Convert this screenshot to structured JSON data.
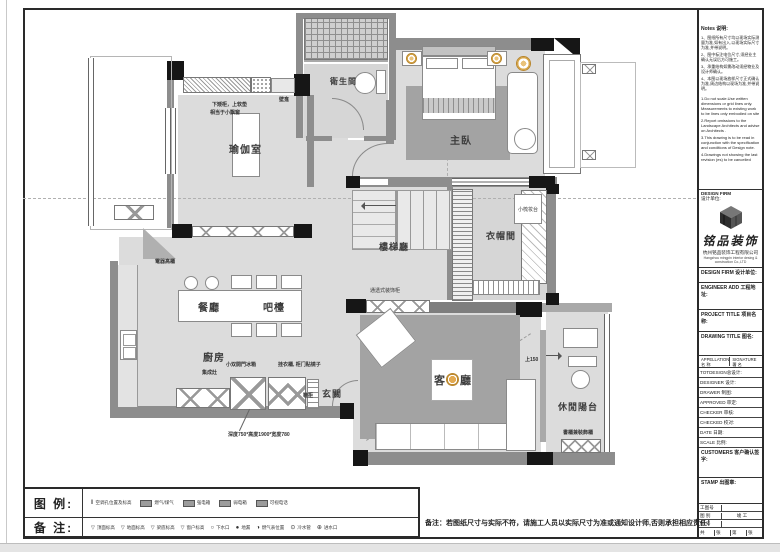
{
  "page": {
    "legend_caption": "图 例:",
    "remark_caption": "备 注:",
    "bottom_remark": "备注：若图纸尺寸与实际不符，请施工人员以实际尺寸为准或通知设计师,否则承担相应责任！"
  },
  "plan": {
    "rooms": {
      "yoga": "瑜伽室",
      "bath": "衛生間",
      "master": "主臥",
      "cloak": "衣帽間",
      "stair": "樓梯廳",
      "dining": "餐廳",
      "bar": "吧檯",
      "kitchen": "廚房",
      "foyer": "玄關",
      "living_left": "客",
      "living_right": "廳",
      "balcony": "休閒陽台"
    },
    "annotations": {
      "seat1": "下矮柜，上软垫",
      "seat2": "相当于小飘窗",
      "niche": "壁龛",
      "elec_cabinet": "電器高櫃",
      "dresser": "小梳妆台",
      "display_cabinet": "通透式装饰柜",
      "stove": "集成灶",
      "fridge": "小双開門冰箱",
      "wardrobe": "挂衣櫃, 柜门贴镜子",
      "shoe": "鞋柜",
      "size_note": "深度750*高度1900*宽度780",
      "up150": "上150",
      "bookcase": "書櫃兼裝飾櫃"
    }
  },
  "legend": {
    "row1": [
      {
        "label": "空调孔位置及标高"
      },
      {
        "label": "燃气/煤气"
      },
      {
        "label": "强电箱"
      },
      {
        "label": "弱电箱"
      },
      {
        "label": "可视电话"
      }
    ],
    "row2": [
      {
        "label": "顶面标高"
      },
      {
        "label": "地面标高"
      },
      {
        "label": "梁底标高"
      },
      {
        "label": "窗户标高"
      },
      {
        "label": "下水口"
      },
      {
        "label": "地漏"
      },
      {
        "label": "燃气表位置"
      },
      {
        "label": "冷水管"
      },
      {
        "label": "进水口"
      }
    ],
    "icons": {
      "drain_open": "○",
      "drain_dot": "●",
      "gas_meter": "◑",
      "cold_pipe": "⊙",
      "inlet": "⊕",
      "elev": "▽",
      "dbl": "‖"
    }
  },
  "sidebar": {
    "notes_title": "Notes 说明:",
    "notes_cn": [
      "1、图纸所有尺寸均以现场实际测量为准,如有出入,以现场实际尺寸为准,并带说明。",
      "2、图中标注电位尺寸,须经业主确认无误后方可施工。",
      "3、承重结构如需改动须经物业及设计师确认。",
      "4、本图以现场放样尺寸正式确认为准,周边结构以现场为准,并带说明。"
    ],
    "notes_en": [
      "1.Do not scale.Use written dimensions or grid lines only. Measurements to existing work to be lines only embodied on site",
      "2.Report omissions to the Landscape Architects and advise on Architects .",
      "3.This drawing is to be read in conjunction with the specification and conditions of Design note.",
      "4.Drawings not showing the last revision (es) to be cancelled"
    ],
    "design_firm_en": "DESIGN FIRM",
    "design_firm_cn": "设计单位:",
    "brand": "铭品装饰",
    "company_cn": "杭州铭品装饰工程有限公司",
    "company_en": "Hangzhou mingpin interior desing & construction Co.,LTD",
    "design_firm_row": "DESIGN FIRM  设计单位:",
    "engineer_add": "ENGINEER ADD  工程地址:",
    "project_title": "PROJECT TITLE  项目名称:",
    "drawing_title": "DRAWING TITLE  图名:",
    "appellation_en": "APPELLATION",
    "appellation_cn": "名 称",
    "signature_en": "SIGNATURE",
    "signature_cn": "署 名",
    "rows": [
      "TOTDESIGN总设计:",
      "DESIGNER 设计:",
      "DRAWER 制图:",
      "APPROVED 审定:",
      "CHECKER 审核:",
      "CHECKED 校对:",
      "DATE 日期:",
      "SCALE 比例:"
    ],
    "customers": "CUSTOMERS 客户确认签字:",
    "stamp": "STAMP 出图章:",
    "table": {
      "r1": "工图号",
      "r2": "图 别",
      "r2_val": "竣 工",
      "r3": "图 号",
      "c1": "共",
      "c2": "张",
      "c3": "第",
      "c4": "张"
    }
  }
}
